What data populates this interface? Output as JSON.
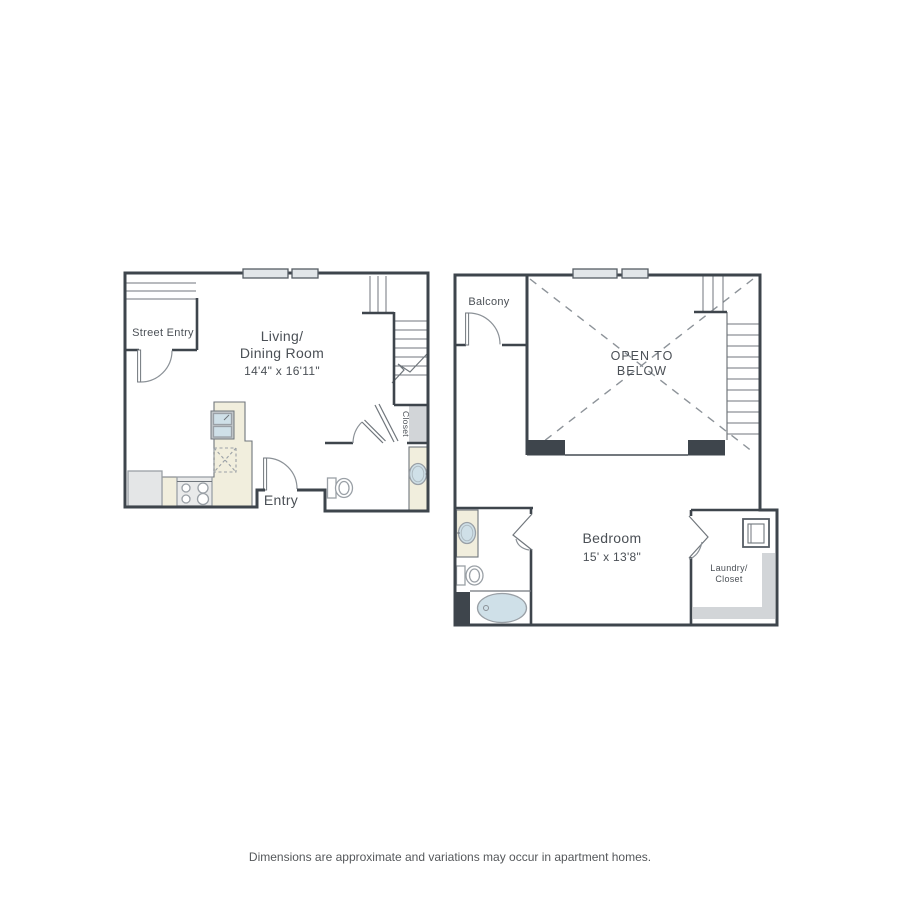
{
  "document": {
    "type": "apartment floor plan",
    "footer_disclaimer": "Dimensions are approximate and variations may occur in apartment homes."
  },
  "colors": {
    "wall": "#3e454c",
    "counter_cream": "#f1eedd",
    "fixture_water_blue": "#cfe0e8",
    "shaded_gray": "#d2d5d8",
    "label_text": "#4b5056",
    "background": "#ffffff"
  },
  "floor1": {
    "street_entry_label": "Street Entry",
    "room_name_line1": "Living/",
    "room_name_line2": "Dining Room",
    "room_dimensions": "14'4\" x 16'11\"",
    "entry_label": "Entry",
    "closet_label": "Closet"
  },
  "floor2": {
    "balcony_label": "Balcony",
    "open_below_line1": "OPEN TO",
    "open_below_line2": "BELOW",
    "bedroom_label": "Bedroom",
    "bedroom_dimensions": "15' x 13'8\"",
    "laundry_line1": "Laundry/",
    "laundry_line2": "Closet"
  }
}
